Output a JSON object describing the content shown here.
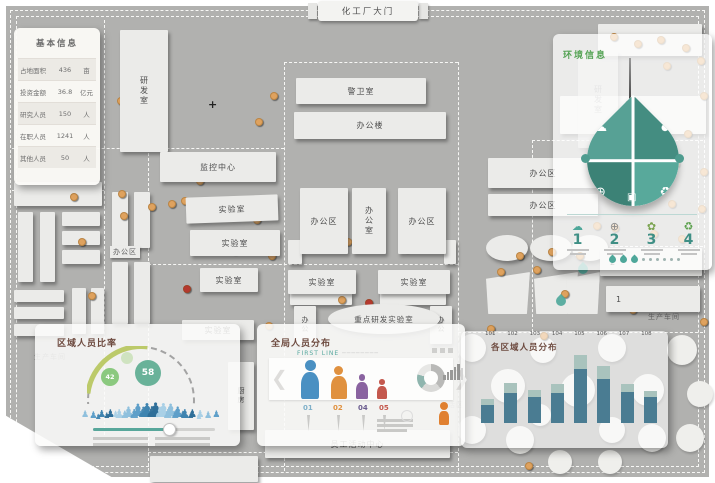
{
  "gate": {
    "label": "化工厂大门"
  },
  "icons": {
    "cursor": "+",
    "cloud": "☁",
    "globe": "⊕",
    "flower": "✿",
    "recycle": "♻",
    "gift": "▣",
    "chevron_left": "❮",
    "chevron_right": "❯"
  },
  "basic_info": {
    "title": "基本信息",
    "rows": [
      {
        "label": "占地面积",
        "value": "436",
        "unit": "亩"
      },
      {
        "label": "投资金额",
        "value": "36.8",
        "unit": "亿元"
      },
      {
        "label": "研究人员",
        "value": "150",
        "unit": "人"
      },
      {
        "label": "在职人员",
        "value": "1241",
        "unit": "人"
      },
      {
        "label": "其他人员",
        "value": "50",
        "unit": "人"
      }
    ]
  },
  "buildings": {
    "rd_room": "研发室",
    "guard_room": "警卫室",
    "office_building": "办公楼",
    "monitor_center": "监控中心",
    "lab": "实验室",
    "office_area": "办公区",
    "office_room": "办公室",
    "office_small": "办公",
    "key_lab": "重点研发实验室",
    "production_workshop": "生产车间",
    "staff_center": "员工活动中心",
    "kitchen": "厨房",
    "living_area": "生活区",
    "building_no1": "1",
    "building_no2": "2"
  },
  "env_panel": {
    "title": "环境信息",
    "step_numbers": [
      "1",
      "2",
      "3",
      "4"
    ]
  },
  "region_panel": {
    "title": "区域人员比率",
    "bubble_small": "42",
    "bubble_large": "58"
  },
  "global_panel": {
    "title": "全局人员分布",
    "subtitle": "FIRST LINE",
    "subtitle_dashes": "────────",
    "figure_labels": [
      "01",
      "02",
      "04",
      "05"
    ]
  },
  "area_panel": {
    "title": "各区域人员分布"
  },
  "chart_data": [
    {
      "type": "bar",
      "title": "各区域人员分布",
      "categories": [
        "101",
        "102",
        "103",
        "104",
        "105",
        "106",
        "107",
        "108"
      ],
      "series": [
        {
          "name": "区域人数-主体",
          "color": "#4a7c92",
          "values": [
            18,
            30,
            26,
            30,
            54,
            44,
            31,
            26
          ]
        },
        {
          "name": "区域人数-顶部",
          "color": "#a9c3bd",
          "values": [
            6,
            10,
            7,
            9,
            14,
            13,
            8,
            6
          ]
        }
      ],
      "stacked": true,
      "legend": false,
      "xlabel": "",
      "ylabel": "",
      "ylim": [
        0,
        70
      ]
    },
    {
      "type": "gauge",
      "title": "区域人员比率",
      "values": [
        {
          "label": "42",
          "color": "#8bc97f"
        },
        {
          "label": "58",
          "color": "#69b299"
        }
      ]
    }
  ],
  "markers": {
    "orange_color": "#dfa25e",
    "red_color": "#b5382f",
    "orange_dots": [
      [
        138,
        50
      ],
      [
        124,
        78
      ],
      [
        117,
        97
      ],
      [
        139,
        99
      ],
      [
        146,
        118
      ],
      [
        255,
        118
      ],
      [
        270,
        92
      ],
      [
        330,
        92
      ],
      [
        344,
        83
      ],
      [
        352,
        90
      ],
      [
        360,
        81
      ],
      [
        400,
        127
      ],
      [
        176,
        159
      ],
      [
        193,
        156
      ],
      [
        214,
        166
      ],
      [
        262,
        167
      ],
      [
        196,
        177
      ],
      [
        168,
        200
      ],
      [
        181,
        197
      ],
      [
        199,
        201
      ],
      [
        253,
        216
      ],
      [
        148,
        203
      ],
      [
        231,
        247
      ],
      [
        268,
        252
      ],
      [
        330,
        216
      ],
      [
        344,
        238
      ],
      [
        355,
        196
      ],
      [
        405,
        212
      ],
      [
        338,
        296
      ],
      [
        420,
        276
      ],
      [
        302,
        322
      ],
      [
        265,
        322
      ],
      [
        516,
        252
      ],
      [
        548,
        248
      ],
      [
        576,
        252
      ],
      [
        533,
        266
      ],
      [
        497,
        268
      ],
      [
        561,
        290
      ],
      [
        487,
        325
      ],
      [
        540,
        332
      ],
      [
        593,
        222
      ],
      [
        611,
        224
      ],
      [
        610,
        33
      ],
      [
        634,
        40
      ],
      [
        657,
        36
      ],
      [
        682,
        44
      ],
      [
        697,
        57
      ],
      [
        663,
        62
      ],
      [
        700,
        92
      ],
      [
        684,
        130
      ],
      [
        645,
        152
      ],
      [
        672,
        160
      ],
      [
        700,
        168
      ],
      [
        640,
        195
      ],
      [
        668,
        200
      ],
      [
        698,
        205
      ],
      [
        650,
        230
      ],
      [
        678,
        235
      ],
      [
        620,
        293
      ],
      [
        637,
        297
      ],
      [
        652,
        291
      ],
      [
        664,
        302
      ],
      [
        629,
        306
      ],
      [
        685,
        288
      ],
      [
        70,
        193
      ],
      [
        78,
        238
      ],
      [
        88,
        292
      ],
      [
        118,
        190
      ],
      [
        120,
        212
      ],
      [
        525,
        462
      ],
      [
        700,
        318
      ]
    ],
    "red_dots": [
      [
        310,
        205
      ],
      [
        403,
        245
      ],
      [
        365,
        299
      ],
      [
        183,
        285
      ]
    ],
    "raindrops": [
      [
        556,
        296
      ],
      [
        578,
        264
      ]
    ]
  }
}
